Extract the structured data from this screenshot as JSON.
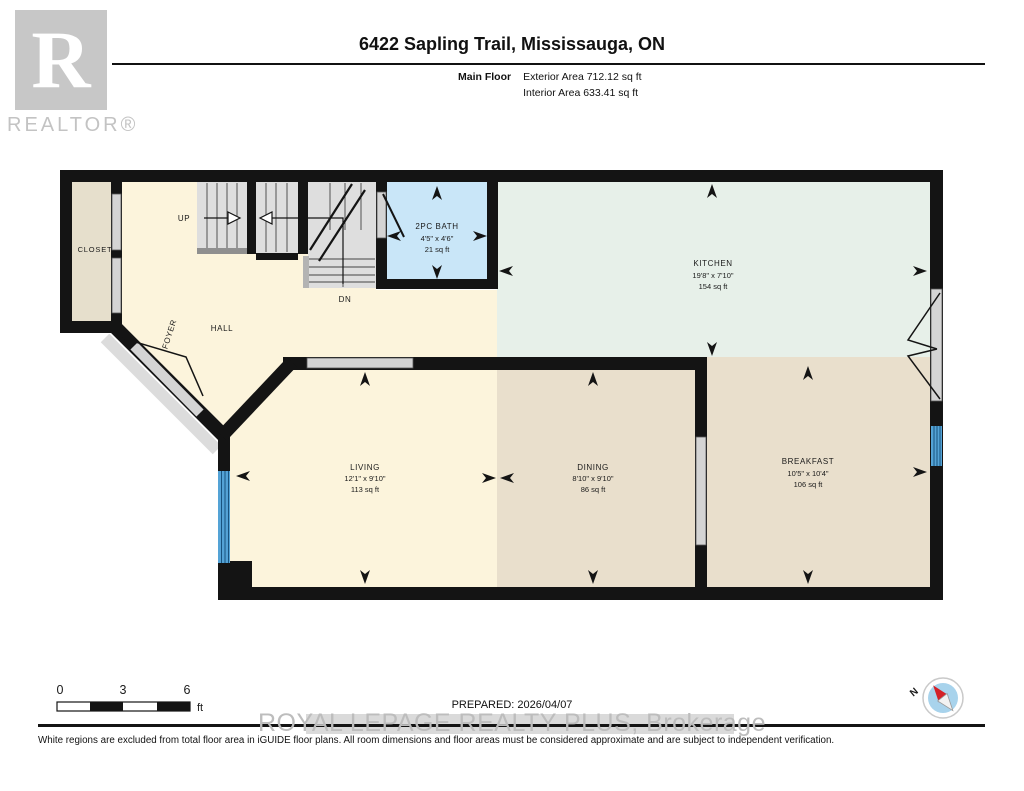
{
  "header": {
    "logo_r": "R",
    "logo_text": "REALTOR®",
    "title": "6422 Sapling Trail, Mississauga, ON",
    "floor_label": "Main Floor",
    "exterior_area": "Exterior Area 712.12 sq ft",
    "interior_area": "Interior Area 633.41 sq ft"
  },
  "rooms": {
    "closet": {
      "name": "CLOSET"
    },
    "hall": {
      "name": "HALL"
    },
    "foyer": {
      "name": "FOYER"
    },
    "bath": {
      "name": "2PC BATH",
      "dims": "4'5\" x 4'6\"",
      "area": "21 sq ft"
    },
    "kitchen": {
      "name": "KITCHEN",
      "dims": "19'8\" x 7'10\"",
      "area": "154 sq ft"
    },
    "living": {
      "name": "LIVING",
      "dims": "12'1\" x 9'10\"",
      "area": "113 sq ft"
    },
    "dining": {
      "name": "DINING",
      "dims": "8'10\" x 9'10\"",
      "area": "86 sq ft"
    },
    "breakfast": {
      "name": "BREAKFAST",
      "dims": "10'5\" x 10'4\"",
      "area": "106 sq ft"
    }
  },
  "stairs": {
    "up": "UP",
    "down": "DN"
  },
  "scale_bar": {
    "t0": "0",
    "t1": "3",
    "t2": "6",
    "unit": "ft"
  },
  "compass": {
    "north": "N"
  },
  "footer": {
    "prepared": "PREPARED: 2026/04/07",
    "watermark": "ROYAL LEPAGE REALTY PLUS, Brokerage",
    "disclaimer": "White regions are excluded from total floor area in iGUIDE floor plans. All room dimensions and floor areas must be considered approximate and are subject to independent verification."
  },
  "colors": {
    "wall": "#141414",
    "cream": "#fcf4dc",
    "mint": "#e7f0e9",
    "tan": "#e9dfcc",
    "closet_beige": "#e6dfcc",
    "bath_blue": "#c9e6f8",
    "window_blue": "#54a3d6",
    "stair_gray": "#dedede",
    "opening_gray": "#d4d4d4"
  }
}
